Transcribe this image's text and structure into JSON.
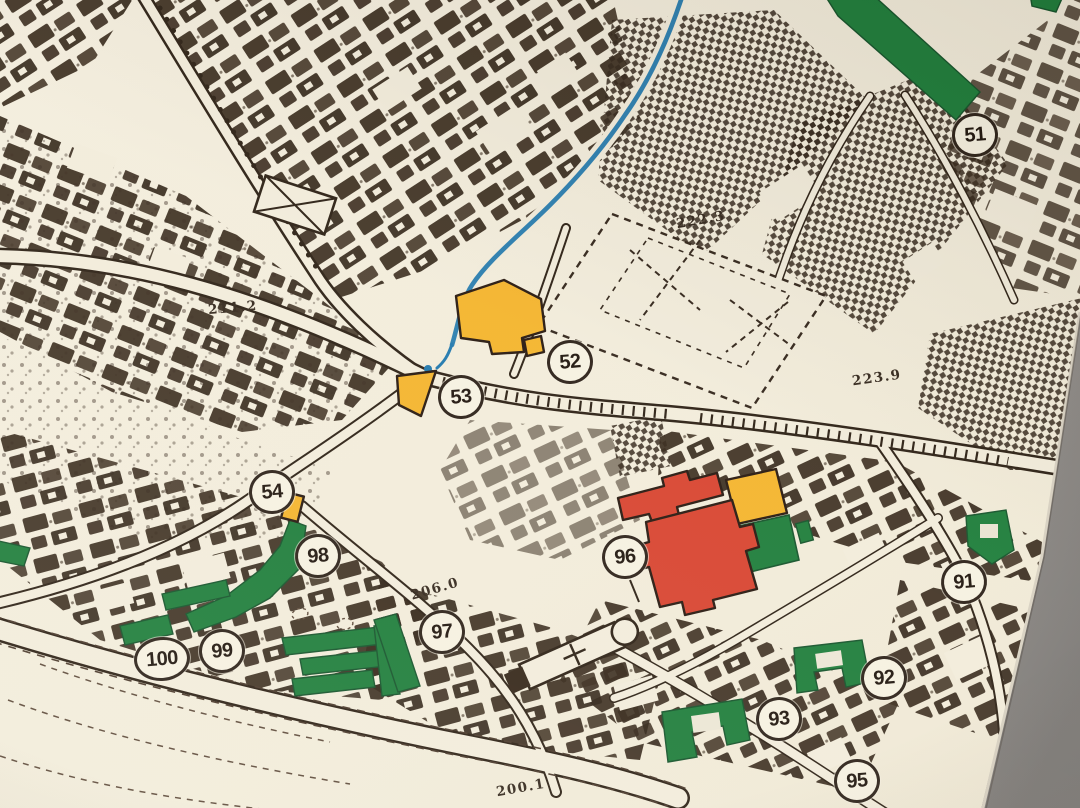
{
  "map": {
    "markers": [
      {
        "label": "51"
      },
      {
        "label": "52"
      },
      {
        "label": "53"
      },
      {
        "label": "54"
      },
      {
        "label": "91"
      },
      {
        "label": "92"
      },
      {
        "label": "93"
      },
      {
        "label": "95"
      },
      {
        "label": "96"
      },
      {
        "label": "97"
      },
      {
        "label": "98"
      },
      {
        "label": "99"
      },
      {
        "label": "100"
      }
    ],
    "elevations": [
      {
        "text": "211.2"
      },
      {
        "text": "222.3"
      },
      {
        "text": "223.9"
      },
      {
        "text": "206.0"
      },
      {
        "text": "200.1"
      }
    ],
    "colors": {
      "paper": "#f2ecdb",
      "ink": "#33261b",
      "landmark_red": "#d8432f",
      "landmark_yellow": "#f4b42c",
      "green_space": "#1d7d3a",
      "water_blue": "#2078ad",
      "backdrop_gray": "#8b8785"
    }
  }
}
